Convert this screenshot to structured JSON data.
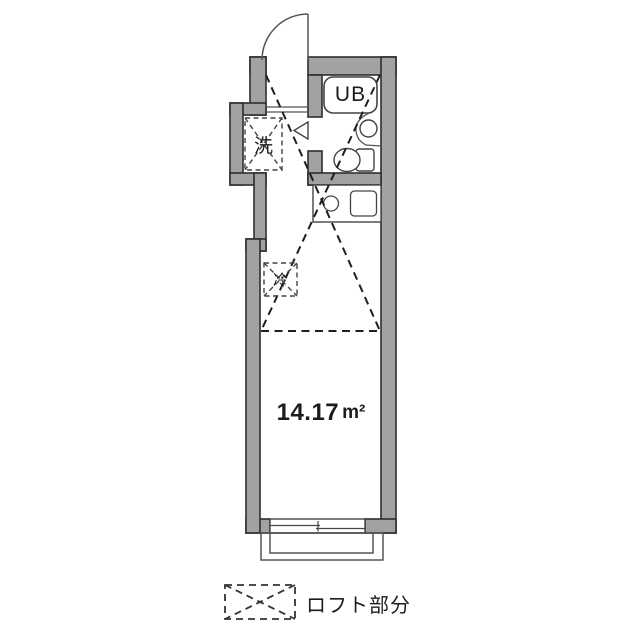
{
  "floorplan": {
    "labels": {
      "unit_bath": "UB",
      "washer": "洗",
      "refrigerator": "冷",
      "area_value": "14.17",
      "area_unit": "m²"
    },
    "legend": {
      "label": "ロフト部分"
    },
    "colors": {
      "wall_fill": "#a2a2a2",
      "wall_outline": "#2e2e2e",
      "fixture_line": "#444444",
      "dash_line": "#1f1f1f",
      "background": "#ffffff"
    }
  }
}
